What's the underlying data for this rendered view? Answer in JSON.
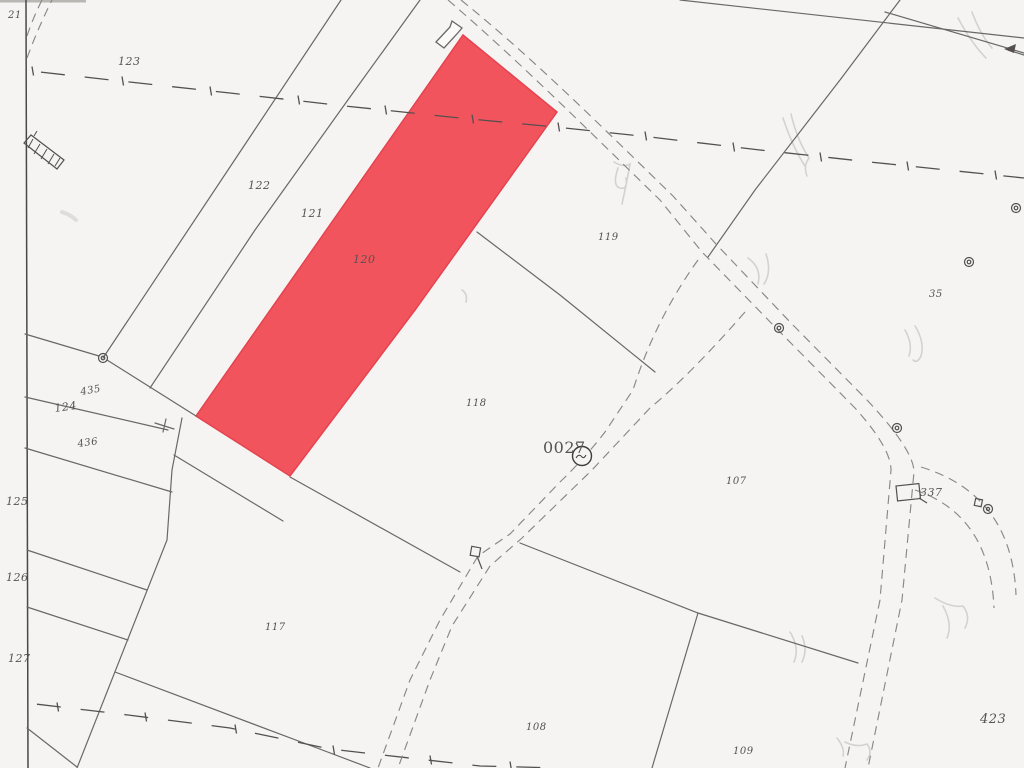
{
  "title": "Cadastral map scan with highlighted parcel",
  "highlight": {
    "parcel": "120",
    "fill": "#f2545e",
    "stroke": "#e4434f",
    "label_color": "#a83a42"
  },
  "palette": {
    "paper": "#f5f4f2",
    "boundary_line": "#6a6866",
    "admin_line": "#55504e",
    "road_line": "#8a8884"
  },
  "labels": {
    "p21": "21",
    "p123": "123",
    "p122": "122",
    "p121": "121",
    "p120": "120",
    "p119": "119",
    "p118": "118",
    "p117": "117",
    "p124": "124",
    "p125": "125",
    "p126": "126",
    "p127": "127",
    "p435": "435",
    "p436": "436",
    "p107": "107",
    "p108": "108",
    "p109": "109",
    "p337": "337",
    "p35": "35",
    "p423": "423",
    "p0027": "0027"
  },
  "symbols": [
    "survey-point",
    "water-pump-0027",
    "building-outline",
    "hatched-bridge",
    "signpost",
    "direction-arrow"
  ]
}
